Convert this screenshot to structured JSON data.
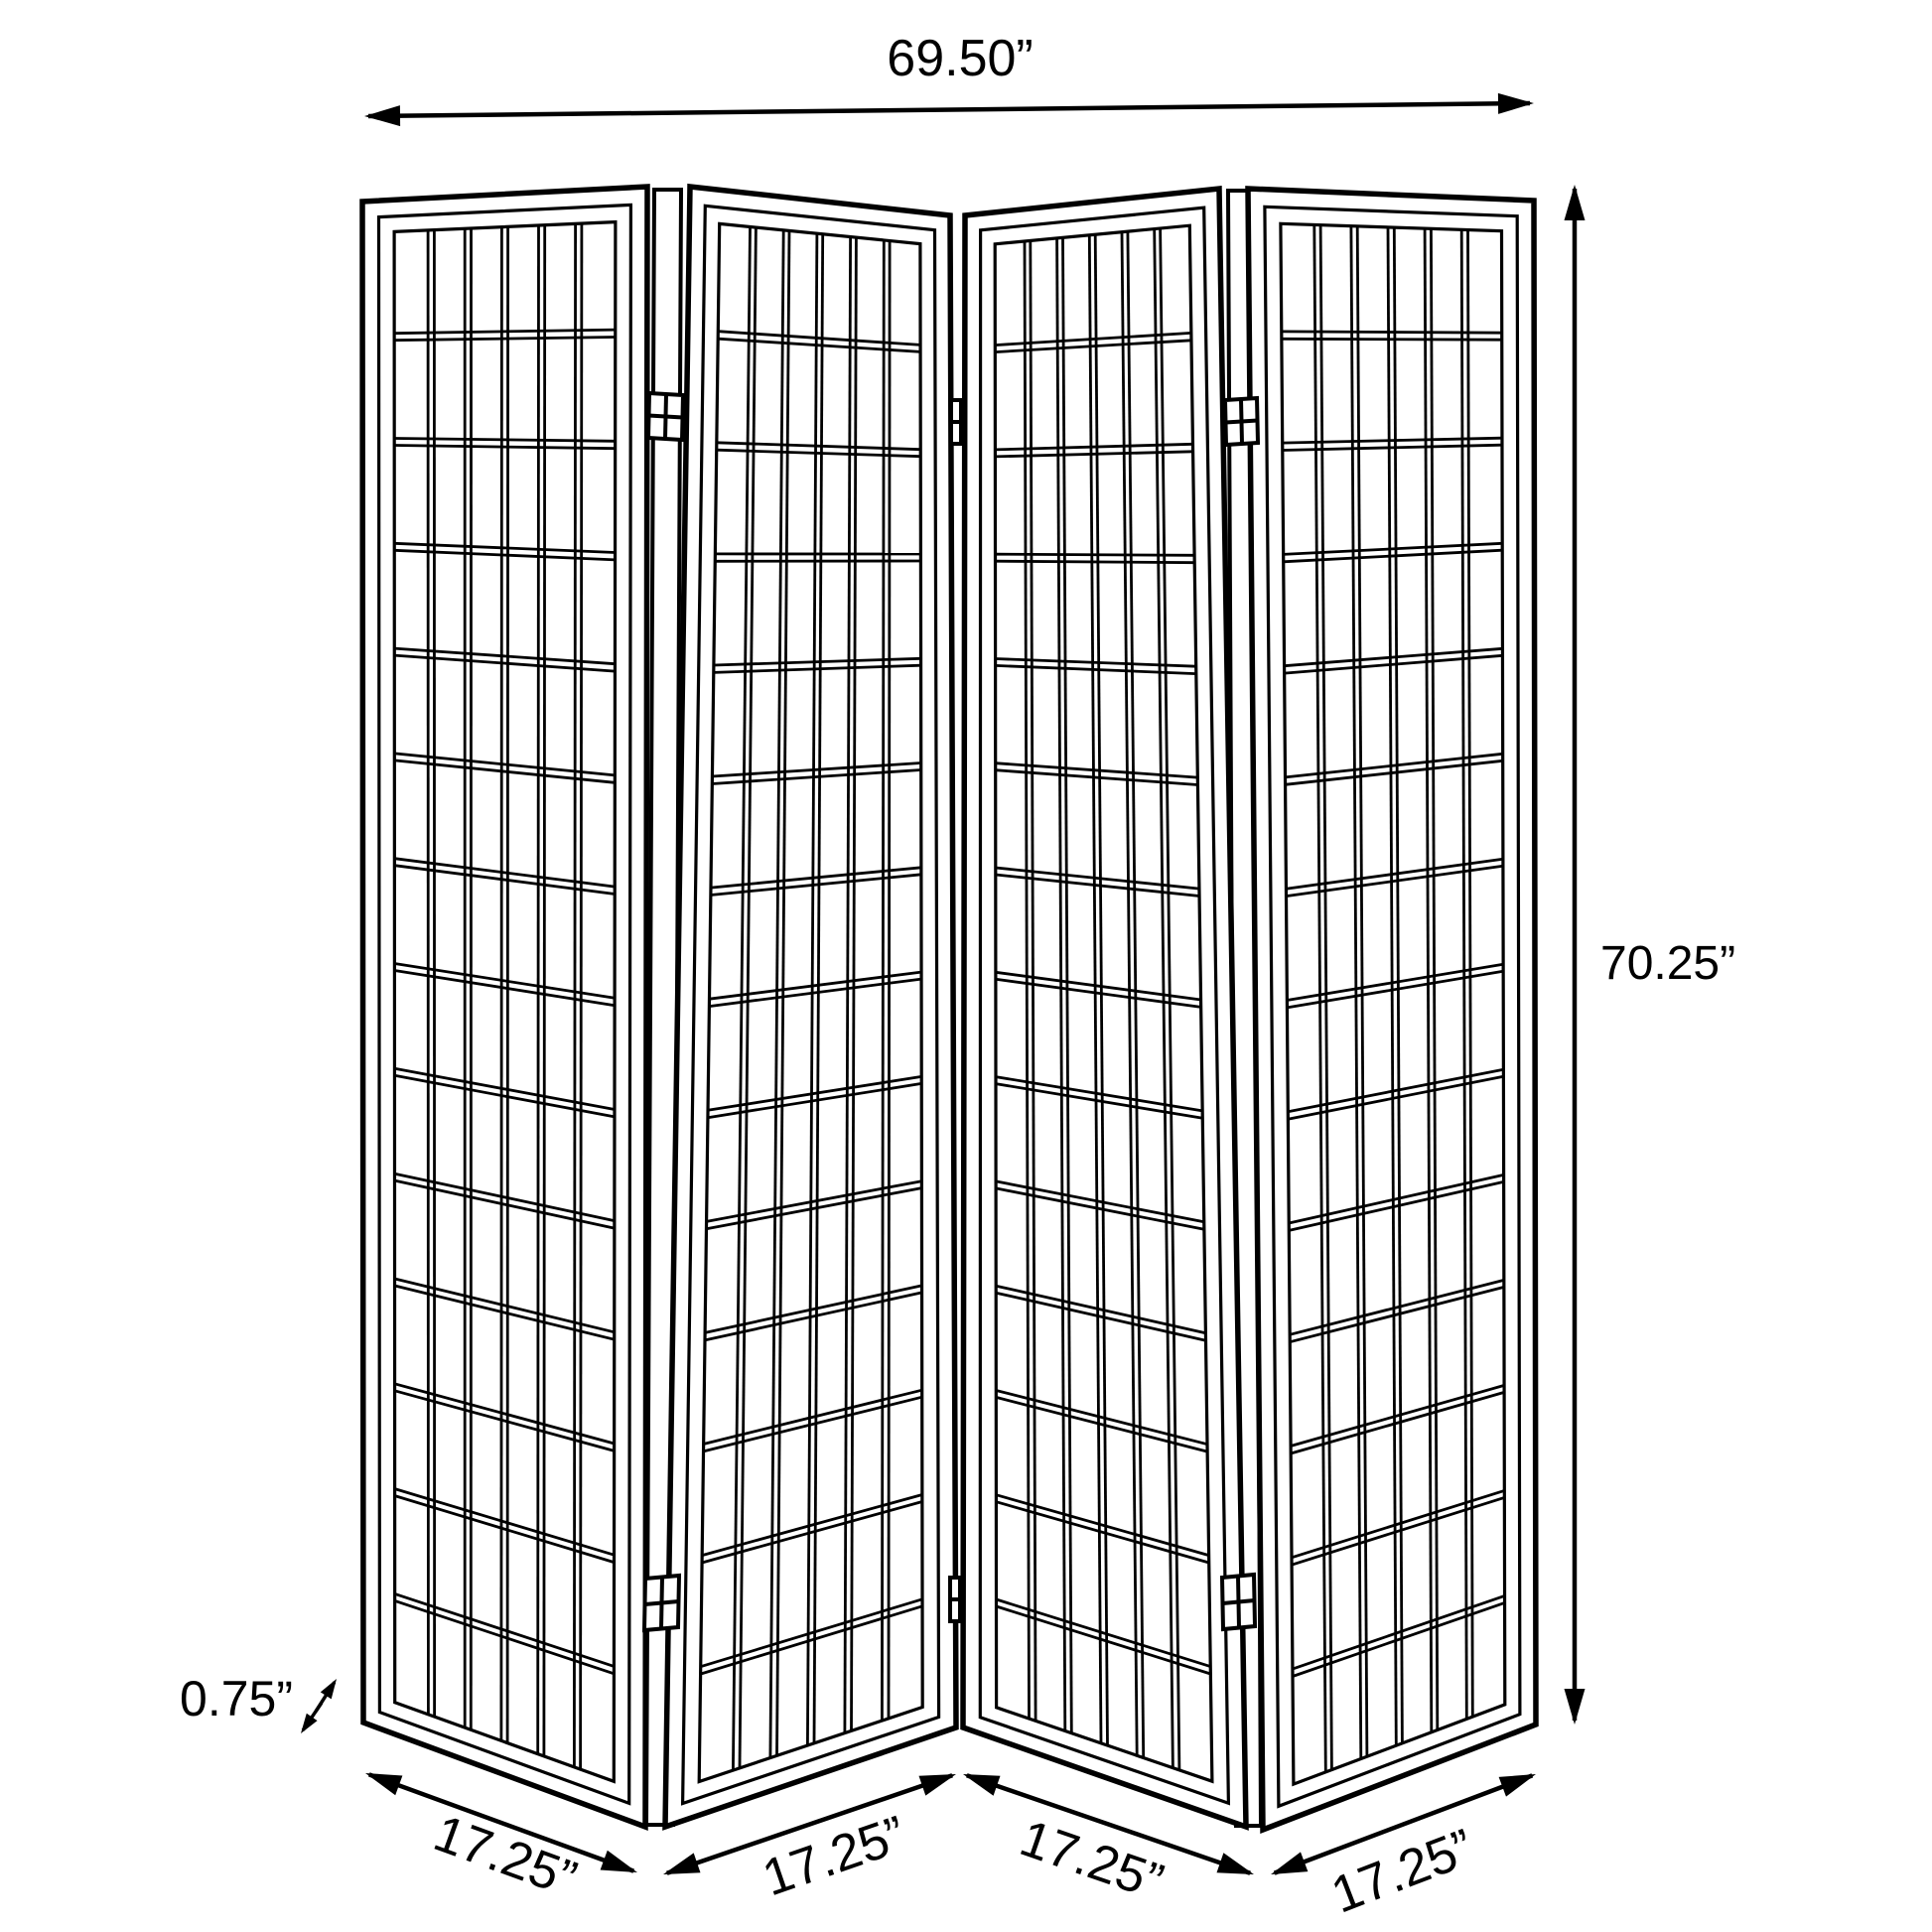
{
  "diagram": {
    "type": "product-dimension-diagram",
    "product": "4-panel folding screen room divider",
    "background_color": "#ffffff",
    "line_color": "#000000",
    "text_color": "#000000",
    "labels": {
      "overall_width": "69.50”",
      "overall_height": "70.25”",
      "frame_thickness": "0.75”",
      "panel_widths": [
        "17.25”",
        "17.25”",
        "17.25”",
        "17.25”"
      ]
    },
    "illustration": {
      "panel_count": 4,
      "grid_columns_per_panel": 6,
      "grid_rows_per_panel": 14,
      "hinge_rows": 2
    }
  }
}
